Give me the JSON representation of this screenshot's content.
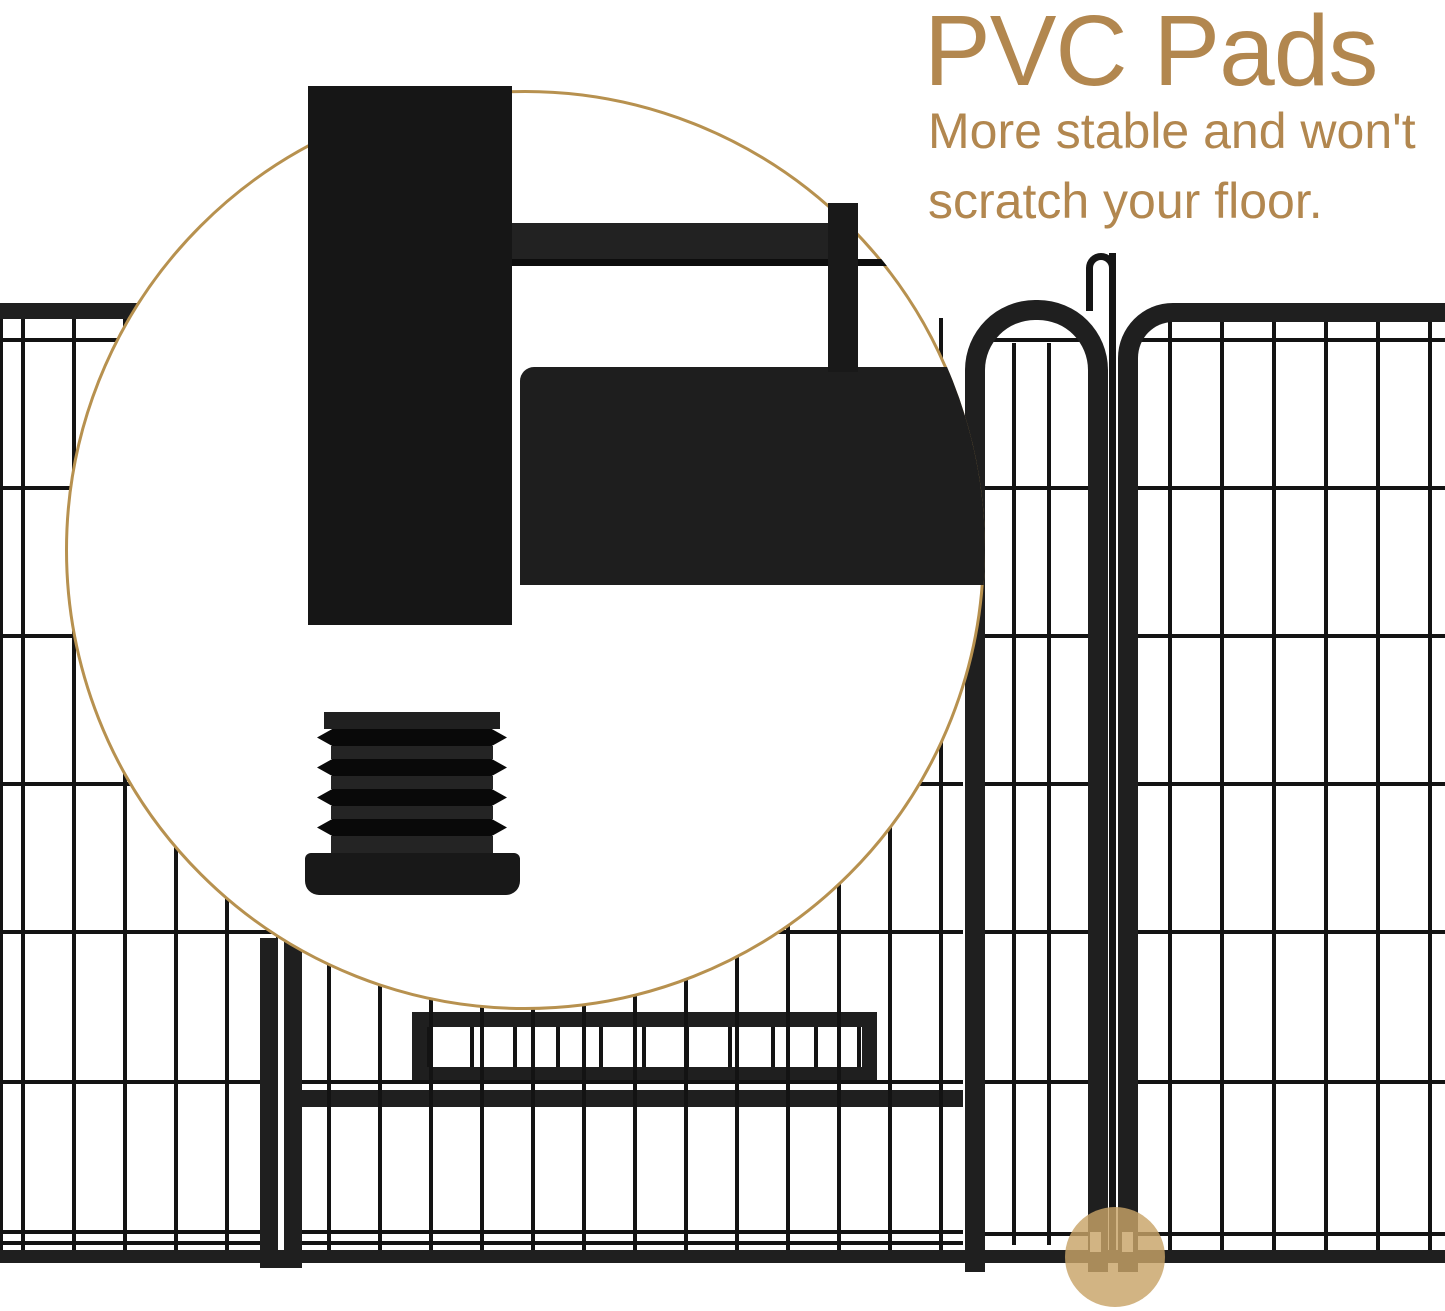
{
  "callout": {
    "title": "PVC Pads",
    "lines": [
      "More stable and won't",
      "scratch your floor."
    ]
  },
  "colors": {
    "accent-text": "#b2874f",
    "circle-border": "#b7914f",
    "fence-frame": "#1f1f1f",
    "fence-wire": "#131313",
    "highlight": "rgba(200,163,104,0.82)"
  },
  "icons": {
    "magnifier_circle": "zoom-detail-callout",
    "highlight_circle": "pad-location-highlight",
    "hook": "gate-latch-hook"
  }
}
